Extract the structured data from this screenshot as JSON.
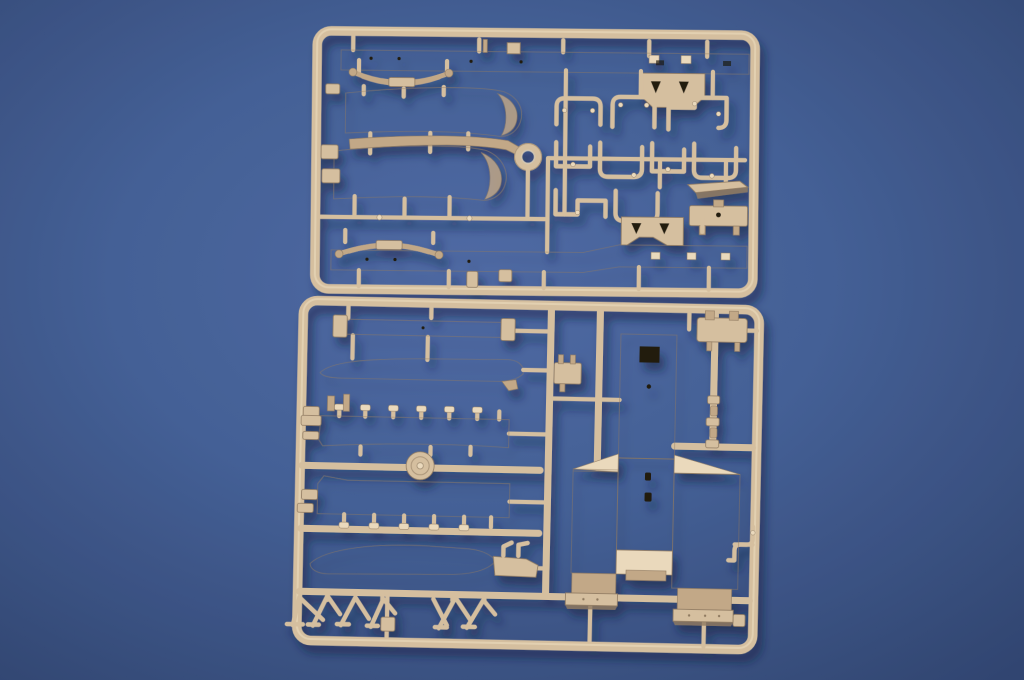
{
  "meta": {
    "type": "photograph",
    "subject": "Two tan injection-molded plastic model-kit sprues photographed on a blue textured backdrop",
    "sprue_count": 2,
    "visible_text": ""
  },
  "palette": {
    "bg-center": "#45629f",
    "bg-mid": "#3a5790",
    "bg-edge": "#263b69",
    "plastic-light": "#ead9bc",
    "plastic-base": "#d5bf9f",
    "plastic-mid": "#c2a887",
    "plastic-dark": "#8f7a61",
    "plastic-deep": "#6b573f",
    "hole": "#201a10",
    "shadow": "#0e1c40"
  },
  "sprues": [
    {
      "id": "sprue-upper",
      "position": "top half of photo",
      "plastic_color": "tan",
      "parts": [
        "chassis-rail-top",
        "leaf-spring-top",
        "axle-bracket-top",
        "fender-band-upper",
        "fender-strip",
        "fender-band-lower",
        "ring-part",
        "pipe-cluster (nine small piping brackets)",
        "flat-plate",
        "plate-with-hole",
        "chassis-rail-bottom",
        "leaf-spring-bottom",
        "axle-bracket-bottom",
        "small-clips"
      ]
    },
    {
      "id": "sprue-lower",
      "position": "bottom half of photo",
      "plastic_color": "tan",
      "parts": [
        "narrow-beam",
        "running-board-upper",
        "bed-panel-tabs-up",
        "wheel-disc",
        "bed-panel-tabs-down",
        "running-board-lower",
        "support-stands (three A-frame trestles)",
        "small-bracket-left",
        "small-bracket-top-right",
        "link-chain-strip",
        "bent-pipe",
        "cab-rear-body (tower, folded side wings, feet)"
      ]
    }
  ]
}
